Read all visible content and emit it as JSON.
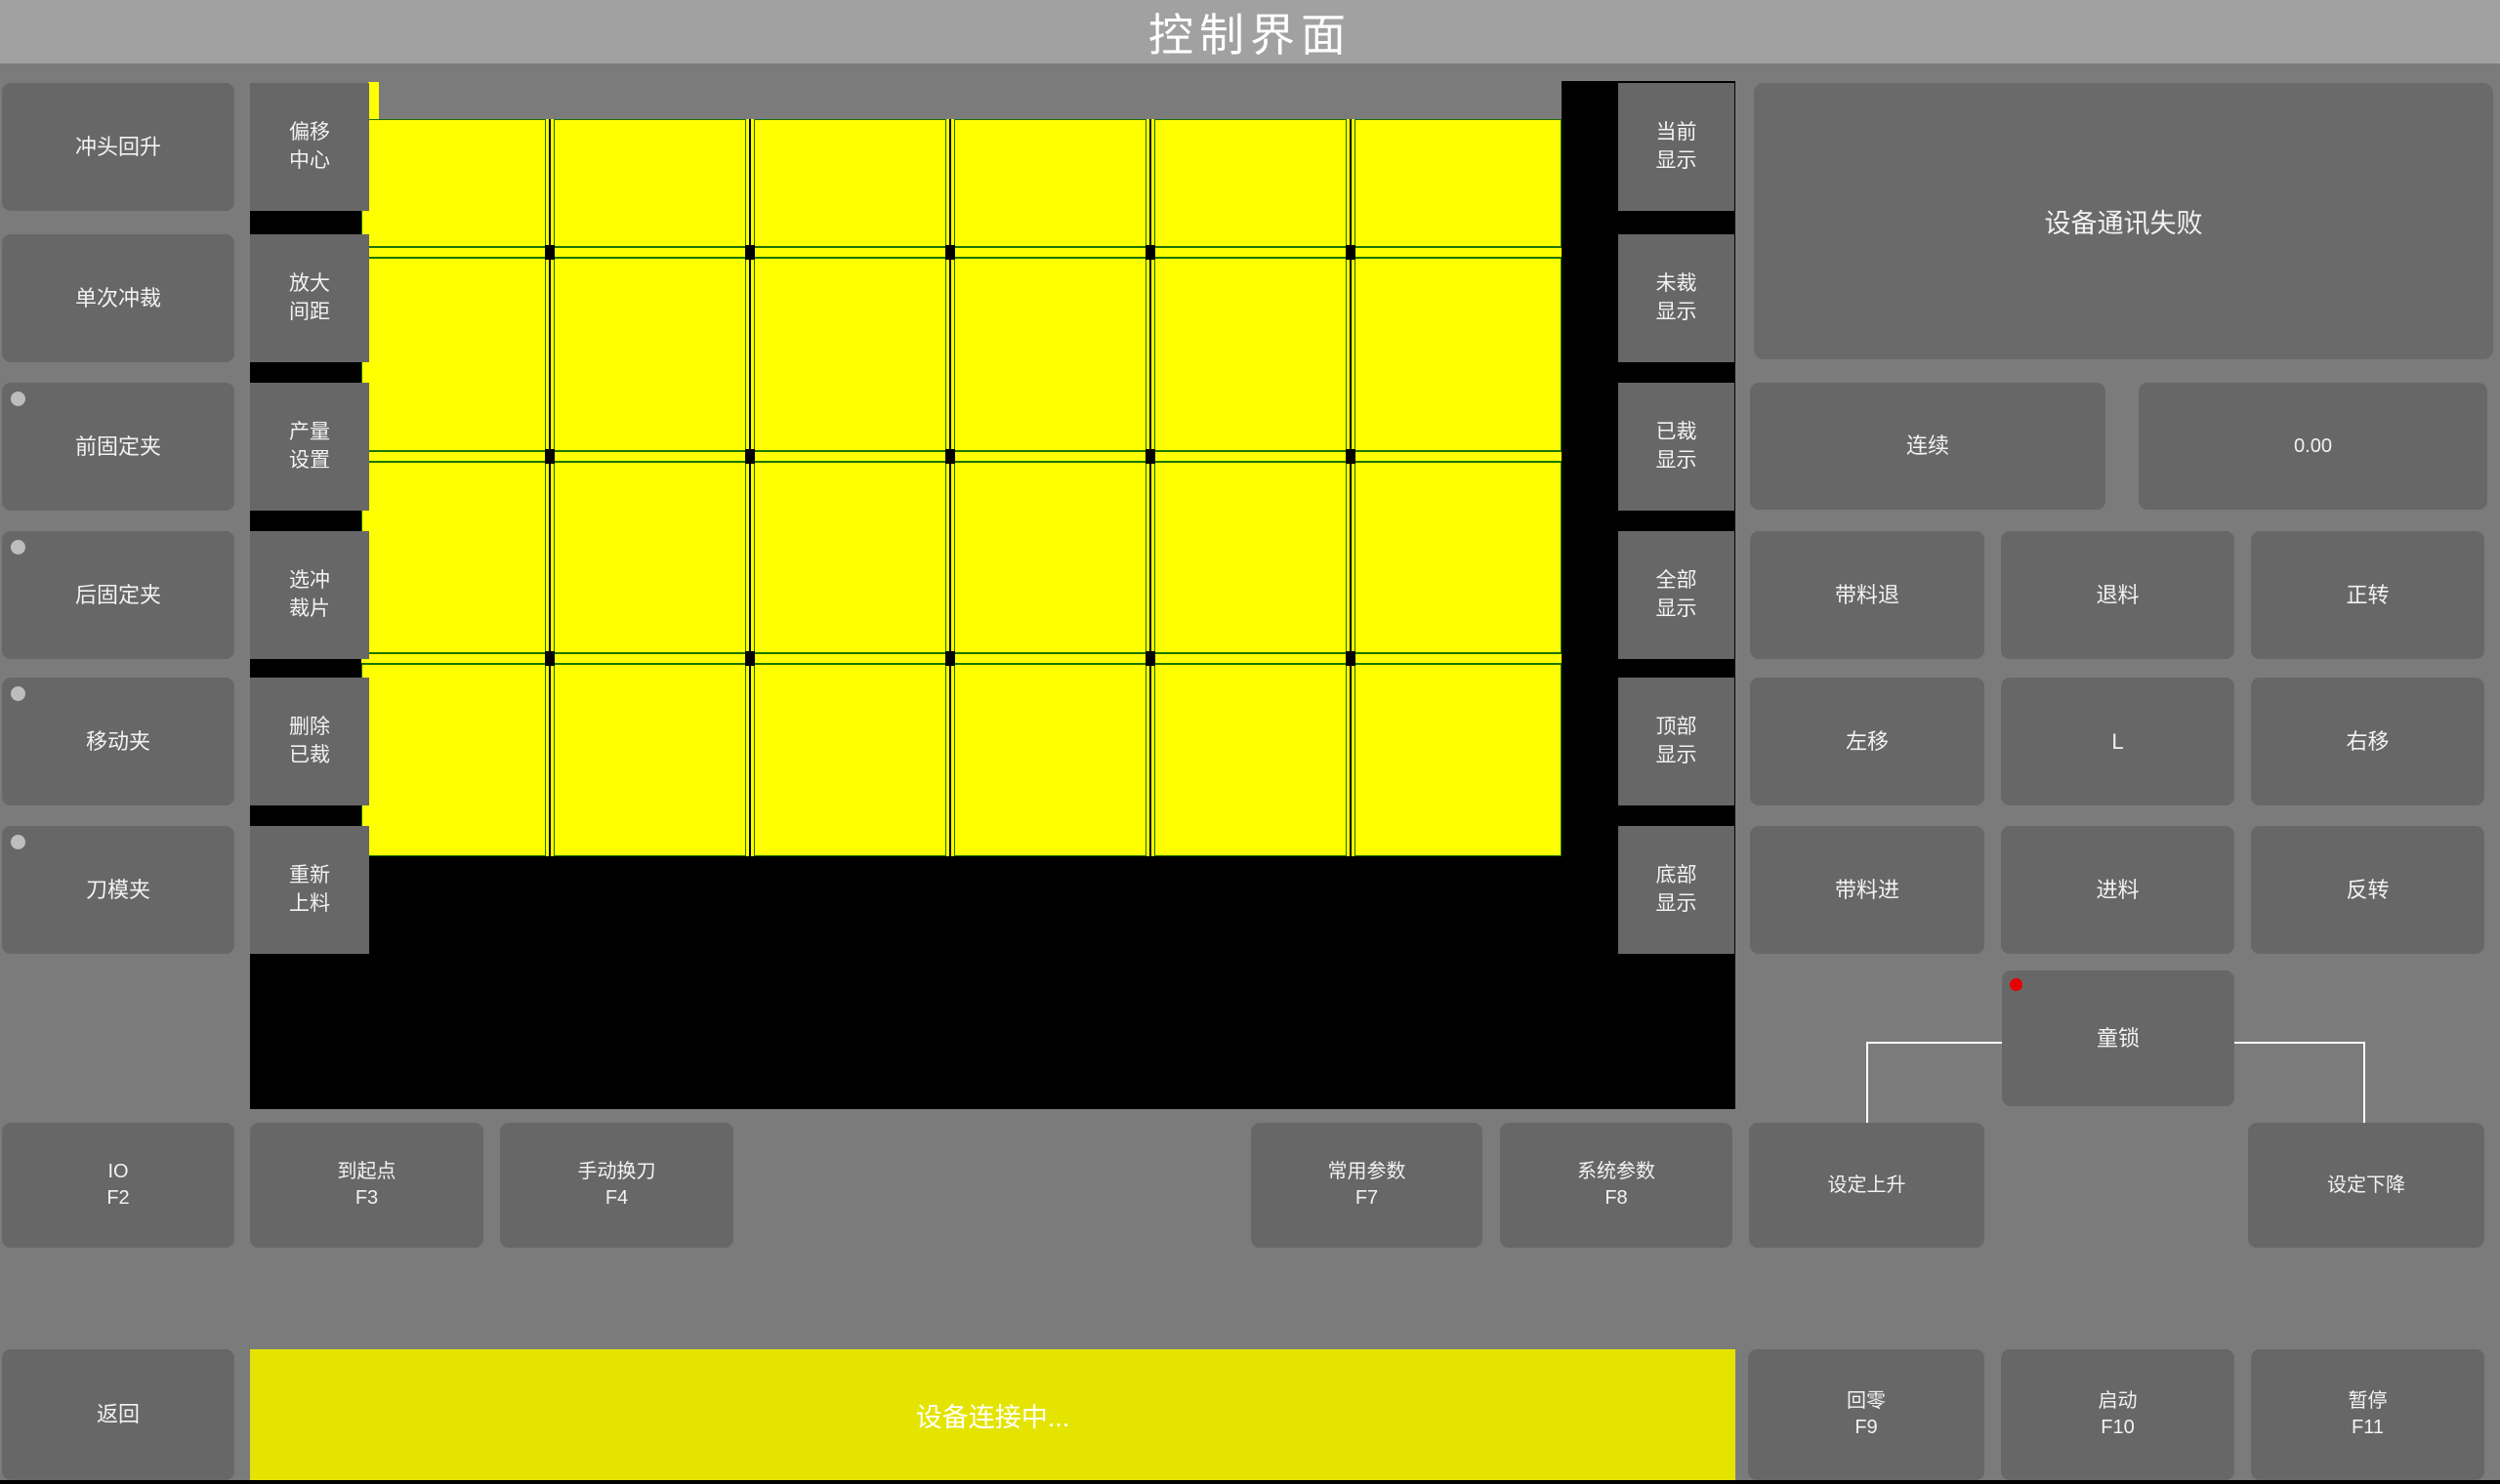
{
  "title_bar": {
    "title": "控制界面"
  },
  "left_panel": {
    "buttons": [
      {
        "label": "冲头回升",
        "indicator": false
      },
      {
        "label": "单次冲裁",
        "indicator": false
      },
      {
        "label": "前固定夹",
        "indicator": true
      },
      {
        "label": "后固定夹",
        "indicator": true
      },
      {
        "label": "移动夹",
        "indicator": true
      },
      {
        "label": "刀模夹",
        "indicator": true
      }
    ]
  },
  "tool_column": {
    "buttons": [
      {
        "line1": "偏移",
        "line2": "中心"
      },
      {
        "line1": "放大",
        "line2": "间距"
      },
      {
        "line1": "产量",
        "line2": "设置"
      },
      {
        "line1": "选冲",
        "line2": "裁片"
      },
      {
        "line1": "删除",
        "line2": "已裁"
      },
      {
        "line1": "重新",
        "line2": "上料"
      }
    ]
  },
  "view_column": {
    "buttons": [
      {
        "line1": "当前",
        "line2": "显示"
      },
      {
        "line1": "未裁",
        "line2": "显示"
      },
      {
        "line1": "已裁",
        "line2": "显示"
      },
      {
        "line1": "全部",
        "line2": "显示"
      },
      {
        "line1": "顶部",
        "line2": "显示"
      },
      {
        "line1": "底部",
        "line2": "显示"
      }
    ]
  },
  "canvas": {
    "grid": {
      "columns": 6,
      "rows": 4
    },
    "colors": {
      "background": "#000000",
      "piece_fill": "#ffff00",
      "piece_border": "#1b7400",
      "status_yellow": "#e4e400"
    }
  },
  "right_panel": {
    "message": "设备通讯失败",
    "mode_button": "连续",
    "value_display": "0.00",
    "jog_buttons": [
      "带料退",
      "退料",
      "正转",
      "左移",
      "L",
      "右移",
      "带料进",
      "进料",
      "反转"
    ],
    "child_lock": "童锁",
    "indicator_color": "#e60000"
  },
  "function_row": {
    "buttons": [
      {
        "label": "IO",
        "key": "F2"
      },
      {
        "label": "到起点",
        "key": "F3"
      },
      {
        "label": "手动换刀",
        "key": "F4"
      },
      {
        "label": "常用参数",
        "key": "F7"
      },
      {
        "label": "系统参数",
        "key": "F8"
      },
      {
        "label": "设定上升",
        "key": ""
      },
      {
        "label": "设定下降",
        "key": ""
      }
    ]
  },
  "bottom_bar": {
    "back": "返回",
    "status": "设备连接中...",
    "buttons": [
      {
        "label": "回零",
        "key": "F9"
      },
      {
        "label": "启动",
        "key": "F10"
      },
      {
        "label": "暂停",
        "key": "F11"
      }
    ]
  }
}
